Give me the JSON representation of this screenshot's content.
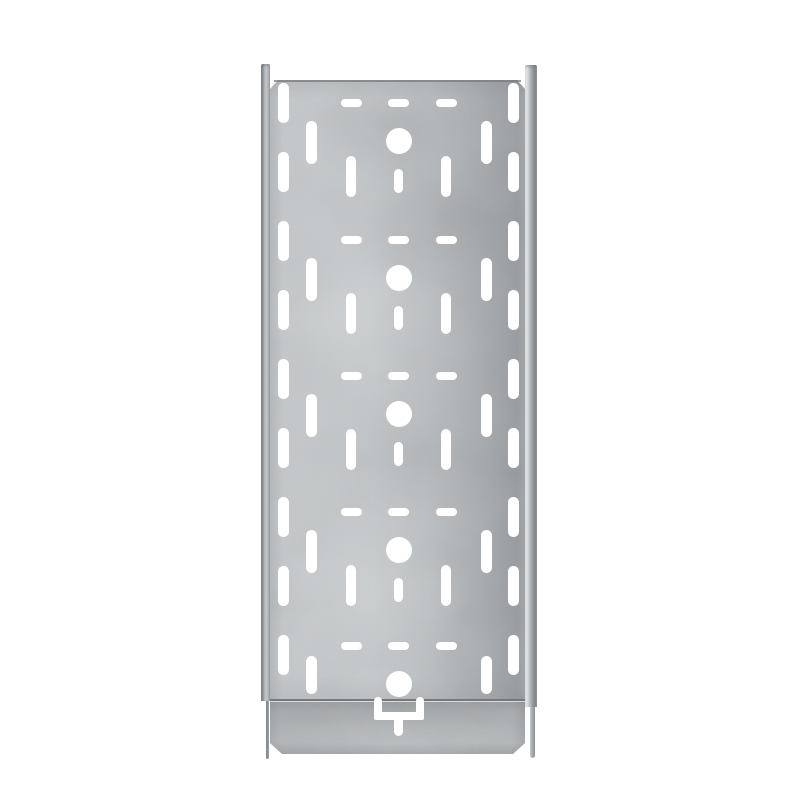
{
  "meta": {
    "alt": "Product photo of a galvanized steel perforated cable tray with coupler end, viewed from above on a white background",
    "background_color": "#ffffff",
    "material_finish": "galvanized-steel"
  },
  "colors": {
    "hole": "#ffffff",
    "steel_light": "#c6c9cb",
    "steel_base": "#bcbfc1",
    "steel_dark": "#989ca0",
    "rail_edge_dark": "#85898c",
    "rail_highlight": "#f1f3f4",
    "seam_line": "#75797b",
    "coupler_base": "#b0b3b5"
  },
  "tray": {
    "panel": {
      "x": 270,
      "y": 80,
      "w": 255,
      "h": 621,
      "chamfer": 8
    },
    "rail_left": {
      "x": 261,
      "y": 64,
      "w": 9,
      "h": 637
    },
    "rail_right": {
      "x": 525,
      "y": 65,
      "w": 12,
      "h": 642
    },
    "tail_left": {
      "x": 265.5,
      "y": 701,
      "w": 3.5,
      "h": 58
    },
    "tail_right": {
      "x": 529.5,
      "y": 707,
      "w": 5,
      "h": 51
    },
    "coupler": {
      "x": 270,
      "y": 701,
      "w": 255,
      "h": 52,
      "chamfer": 12
    },
    "seam": {
      "x": 270,
      "y": 698.5,
      "w": 255,
      "h": 2.5
    },
    "topline": {
      "x": 274,
      "y": 80,
      "w": 247,
      "h": 1.5
    }
  },
  "perforation": {
    "center_x": 398.5,
    "modules": [
      {
        "cy": 141,
        "full": true
      },
      {
        "cy": 278,
        "full": true
      },
      {
        "cy": 414,
        "full": true
      },
      {
        "cy": 550,
        "full": true
      },
      {
        "cy": 684,
        "full": false,
        "b_cy": 675,
        "b_h": 38
      }
    ],
    "dash": {
      "dx": [
        -47.5,
        0,
        47.5
      ],
      "offset_top": -42,
      "w": 21,
      "h": 8
    },
    "circle": {
      "d": 26
    },
    "slot_b": {
      "dx": 87.5,
      "w": 11,
      "h": 43,
      "center_offset": 1
    },
    "slot_c": {
      "dx": 47.5,
      "w": 10,
      "h": 41,
      "center_offset": 35
    },
    "slot_small": {
      "w": 9,
      "h": 24,
      "center_offset": 40
    },
    "edge_slots": {
      "dx": 115,
      "w": 10.5,
      "h": 40,
      "centers_y": [
        103,
        172,
        241,
        310,
        379,
        448,
        517,
        586,
        655
      ]
    }
  },
  "latch": {
    "center_x": 398.5,
    "leg_w": 8,
    "leg_top": 697,
    "leg_h": 22,
    "span": 50,
    "bar_y": 711.5,
    "bar_h": 8,
    "stem_w": 9.5,
    "stem_top": 713,
    "stem_h": 22.5
  }
}
